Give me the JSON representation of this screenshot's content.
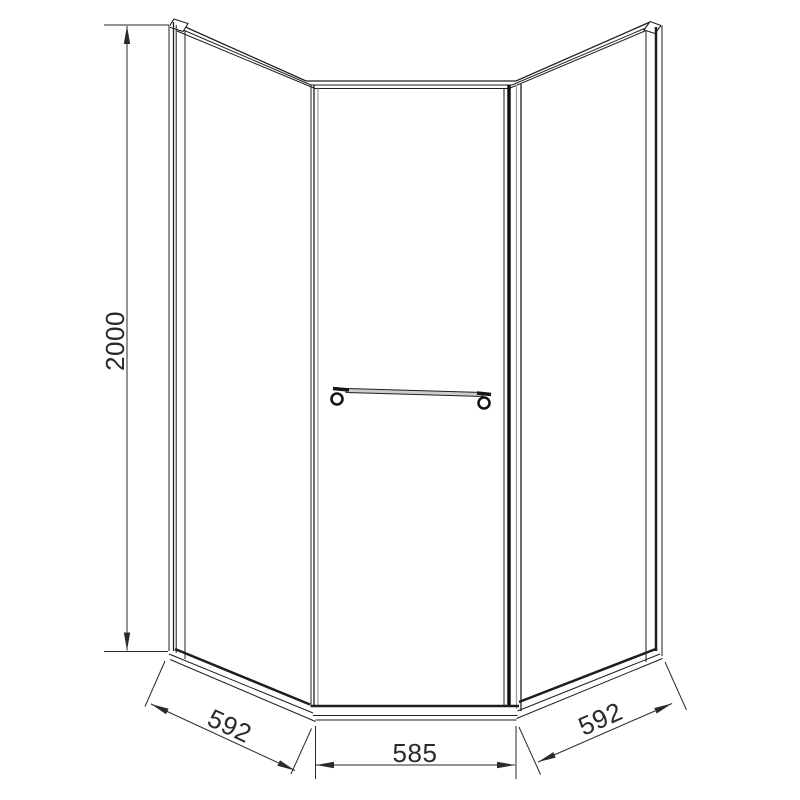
{
  "drawing": {
    "dimensions": {
      "height": "2000",
      "left_width": "592",
      "front_width": "585",
      "right_width": "592"
    },
    "colors": {
      "line": "#1e1e1e",
      "frame_gray": "#909090",
      "dimension": "#2a2a2a",
      "rail_fill": "#cccccc",
      "background": "#ffffff"
    }
  }
}
